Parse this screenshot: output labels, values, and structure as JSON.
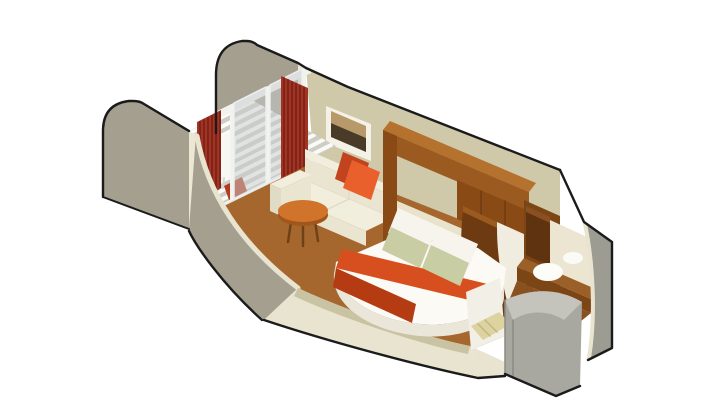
{
  "scene": {
    "label": "Isometric cutaway illustration of a cruise ship balcony stateroom",
    "background": "#ffffff"
  },
  "objects": [
    "balcony-deck",
    "balcony-chair",
    "privacy-partition-left",
    "privacy-partition-rear",
    "sliding-glass-door",
    "red-curtains",
    "framed-artwork",
    "sofa",
    "orange-throw-pillows",
    "round-side-table",
    "double-bed",
    "orange-bed-runner",
    "bed-pillows",
    "headboard-wood-frame",
    "overhead-cabinets",
    "curved-wardrobe",
    "bathroom-vanity-sink",
    "bathroom-mirror",
    "bathroom-cabinet",
    "shower-enclosure",
    "hull-outer-wall",
    "entry-doorway",
    "carpet",
    "cutaway-front-wall"
  ],
  "colors": {
    "outline": "#1b1b1b",
    "wall_taupe": "#a59f90",
    "wall_cream": "#ece7d3",
    "wall_khaki": "#cfc9a9",
    "cut_cream": "#e9e4cf",
    "cut_khaki": "#c9c3a3",
    "deck_base": "#cdcdc6",
    "deck_slat": "#fafaf7",
    "threshold": "#e8e8e2",
    "glass": "#c7ccce",
    "frame_white": "#f3f3ee",
    "curtain_red": "#a33424",
    "curtain_pleat": "#7e2418",
    "mat_red": "#b33a20",
    "carpet": "#a5672e",
    "carpet_dark": "#8a5120",
    "sofa_cream": "#f2eedd",
    "sofa_mid": "#eae5d1",
    "sofa_dark": "#e0dbc4",
    "pillow_orange": "#e9602c",
    "pillow_orange_dark": "#c2441f",
    "art_frame": "#f4f1e6",
    "art_dark": "#4a3a28",
    "art_tan": "#b89a6a",
    "table_top": "#d0742c",
    "table_rim": "#a3561c",
    "table_leg": "#6e4218",
    "bed_white": "#fbfaf5",
    "bed_side": "#eae7da",
    "runner": "#d84f1f",
    "runner_dark": "#b53c12",
    "pillow_white": "#f6f4ec",
    "pillow_white_edge": "#ddd9cb",
    "pillow_sage": "#c8cda3",
    "pillow_sage_dark": "#b6c090",
    "headboard_panel": "#e9e3cc",
    "wood_dark": "#6e3a12",
    "wood_mid": "#8a4a16",
    "wood_beam": "#9a5a20",
    "wood_light": "#b5712e",
    "bath_wall": "#7c4516",
    "bath_cabinet": "#5f3210",
    "bath_cabinet_top": "#8a5020",
    "bath_counter": "#9a6028",
    "mirror": "#ece5d2",
    "porcelain": "#fcfcf9",
    "porcelain_edge": "#d8d4c6",
    "gray_wall": "#9c9c92",
    "gray_light": "#c4c4bc",
    "gray_mid": "#a8a8a0",
    "gray_dark": "#8b8b83",
    "interior_white": "#f0ece0",
    "entry_wood": "#ddd3a0",
    "entry_wood_line": "#c2b681",
    "doorway_white": "#f2efe6",
    "chair_white": "#f7f7f3",
    "chair_shade": "#d8d8d2"
  }
}
